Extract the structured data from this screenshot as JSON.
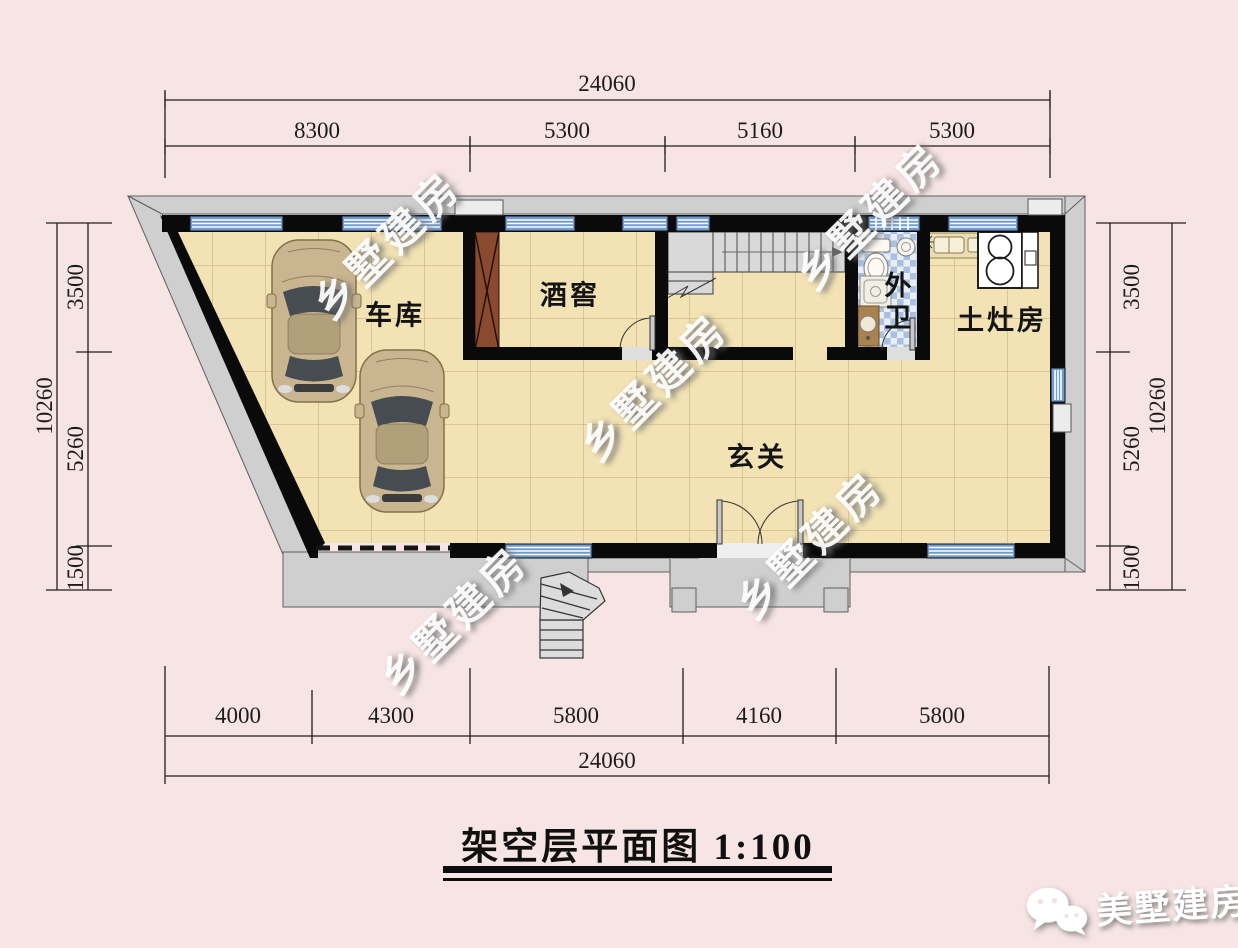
{
  "page": {
    "background": "#f7e4e4"
  },
  "title": "架空层平面图 1:100",
  "watermark_text": "乡墅建房",
  "brand": {
    "name": "美墅建房",
    "icon": "wechat-icon"
  },
  "rooms": {
    "garage": "车库",
    "wine_cellar": "酒窖",
    "outer_bath": "外卫",
    "stove_room": "土灶房",
    "foyer": "玄关"
  },
  "dimensions": {
    "top": {
      "total": "24060",
      "segments": [
        "8300",
        "5300",
        "5160",
        "5300"
      ]
    },
    "bottom": {
      "total": "24060",
      "segments": [
        "4000",
        "4300",
        "5800",
        "4160",
        "5800"
      ]
    },
    "left": {
      "total": "10260",
      "segments": [
        "3500",
        "5260",
        "1500"
      ]
    },
    "right": {
      "total": "10260",
      "segments": [
        "3500",
        "5260",
        "1500"
      ]
    }
  },
  "colors": {
    "background": "#f7e4e4",
    "wall": "#0a0a0a",
    "floor_tile": "#f2e2b4",
    "window_blue": "#6f9ccd",
    "bath_tile": "#a9c0de",
    "paving_gray": "#cfcfcf",
    "wood_chute": "#8a4a30",
    "watermark": "#ffffff"
  }
}
